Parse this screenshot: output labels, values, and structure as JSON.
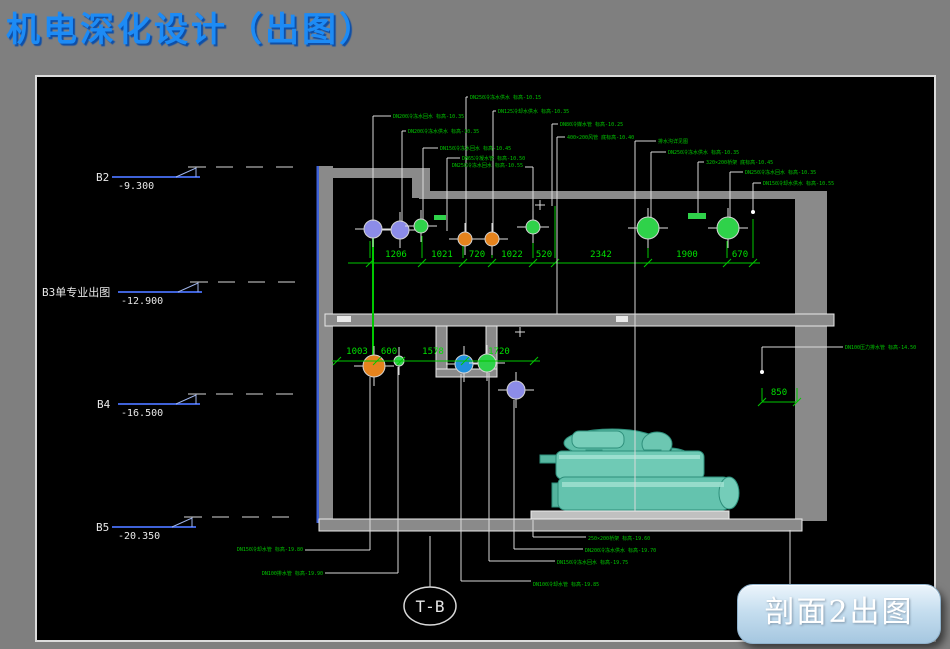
{
  "page": {
    "title": "机电深化设计（出图）",
    "title_color": "#1d8bf5",
    "background": "#7f7f7f"
  },
  "button": {
    "label": "剖面2出图"
  },
  "grid_bubble": {
    "label": "T-B",
    "cx": 430,
    "cy": 606
  },
  "levels": [
    {
      "name": "B2",
      "elev": "-9.300",
      "y": 177,
      "nx": 96,
      "ex": 118,
      "lx1": 112,
      "lx2": 200
    },
    {
      "name": "B3单专业出图",
      "elev": "-12.900",
      "y": 292,
      "nx": 42,
      "ex": 121,
      "lx1": 118,
      "lx2": 202
    },
    {
      "name": "B4",
      "elev": "-16.500",
      "y": 404,
      "nx": 97,
      "ex": 121,
      "lx1": 118,
      "lx2": 200
    },
    {
      "name": "B5",
      "elev": "-20.350",
      "y": 527,
      "nx": 96,
      "ex": 118,
      "lx1": 112,
      "lx2": 196
    }
  ],
  "dimensions": {
    "top": {
      "y": 263,
      "x1": 348,
      "x2": 760,
      "label_y": 257,
      "ticks": [
        370,
        422,
        463,
        492,
        533,
        555,
        648,
        727,
        753
      ],
      "labels": [
        [
          "1206",
          396
        ],
        [
          "1021",
          442
        ],
        [
          "720",
          477
        ],
        [
          "1022",
          512
        ],
        [
          "520",
          544
        ],
        [
          "2342",
          601
        ],
        [
          "1900",
          687
        ],
        [
          "670",
          740
        ]
      ]
    },
    "mid": {
      "y": 361,
      "x1": 332,
      "x2": 540,
      "label_y": 354,
      "ticks": [
        337,
        377,
        401,
        465,
        534
      ],
      "labels": [
        [
          "1003",
          357
        ],
        [
          "600",
          389
        ],
        [
          "1578",
          433
        ],
        [
          "1720",
          499
        ]
      ]
    },
    "side": {
      "y": 402,
      "x1": 762,
      "x2": 797,
      "label_y": 395,
      "ticks": [
        762,
        797
      ],
      "labels": [
        [
          "850",
          779
        ]
      ]
    }
  },
  "pipe_colors": {
    "purple": "#8c8ce8",
    "green": "#2fd24a",
    "orange": "#e5831d",
    "blue": "#2090dd"
  },
  "pipes": [
    [
      373,
      229,
      9,
      "purple"
    ],
    [
      400,
      230,
      9,
      "purple"
    ],
    [
      421,
      226,
      7,
      "green"
    ],
    [
      465,
      239,
      7,
      "orange"
    ],
    [
      492,
      239,
      7,
      "orange"
    ],
    [
      533,
      227,
      7,
      "green"
    ],
    [
      648,
      228,
      11,
      "green"
    ],
    [
      728,
      228,
      11,
      "green"
    ],
    [
      374,
      366,
      11,
      "orange"
    ],
    [
      399,
      361,
      5,
      "green"
    ],
    [
      464,
      364,
      9,
      "blue"
    ],
    [
      487,
      363,
      9,
      "green"
    ],
    [
      516,
      390,
      9,
      "purple"
    ]
  ],
  "annotations": [
    {
      "t": "DN250冷冻水供水 标高-10.15",
      "x": 470,
      "y": 99,
      "l": [
        466,
        232
      ]
    },
    {
      "t": "DN125冷却水供水 标高-10.35",
      "x": 498,
      "y": 113,
      "l": [
        493,
        232
      ]
    },
    {
      "t": "DN200冷冻水回水 标高-10.35",
      "x": 393,
      "y": 118,
      "l": [
        373,
        221
      ]
    },
    {
      "t": "DN80冷媒水管 标高-10.25",
      "x": 560,
      "y": 126,
      "l": [
        552,
        206
      ]
    },
    {
      "t": "DN200冷冻水供水 标高-10.35",
      "x": 408,
      "y": 133,
      "l": [
        402,
        222
      ]
    },
    {
      "t": "400×200风管 底标高-10.40",
      "x": 567,
      "y": 139,
      "l": [
        557,
        314
      ]
    },
    {
      "t": "排水沟详见图",
      "x": 658,
      "y": 143,
      "l": [
        635,
        511
      ]
    },
    {
      "t": "DN150冷冻水回水 标高-10.45",
      "x": 440,
      "y": 150,
      "l": [
        423,
        219
      ]
    },
    {
      "t": "DN250冷冻水供水 标高-10.35",
      "x": 668,
      "y": 154,
      "l": [
        651,
        218
      ]
    },
    {
      "t": "DN65冷凝水管 标高-10.50",
      "x": 462,
      "y": 160,
      "l": [
        447,
        231
      ]
    },
    {
      "t": "320×200桥架 底标高-10.45",
      "x": 706,
      "y": 164,
      "l": [
        698,
        213
      ]
    },
    {
      "t": "DN250冷冻水回水 标高-10.55",
      "x": 523,
      "y": 167,
      "a": "e"
    },
    {
      "t": "DN250冷冻水回水 标高-10.35",
      "x": 745,
      "y": 174,
      "l": [
        730,
        218
      ]
    },
    {
      "t": "DN150冷却水供水 标高-10.55",
      "x": 763,
      "y": 185,
      "l": [
        753,
        211
      ]
    },
    {
      "t": "DN100压力排水管 标高-14.50",
      "x": 845,
      "y": 349
    },
    {
      "t": "DN150冷却水管 标高-19.80",
      "x": 303,
      "y": 551,
      "a": "e"
    },
    {
      "t": "DN100排水管 标高-19.90",
      "x": 323,
      "y": 575,
      "a": "e"
    },
    {
      "t": "250×200桥架 标高-19.60",
      "x": 588,
      "y": 540
    },
    {
      "t": "DN200冷冻水供水 标高-19.70",
      "x": 585,
      "y": 552
    },
    {
      "t": "DN150冷冻水回水 标高-19.75",
      "x": 557,
      "y": 564
    },
    {
      "t": "DN100冷却水管 标高-19.85",
      "x": 533,
      "y": 586
    }
  ],
  "drawing": {
    "rects": [
      [
        316.5,
        166,
        3,
        357,
        "#3f62d8",
        "",
        "left-wall-highlight"
      ],
      [
        319,
        166,
        14,
        357,
        "",
        "",
        "left-wall"
      ],
      [
        319,
        168,
        111,
        10,
        "",
        "",
        "upper-ceiling-slab"
      ],
      [
        412,
        168,
        18,
        30,
        "",
        "",
        "ceiling-step"
      ],
      [
        419,
        191,
        408,
        8,
        "",
        "",
        "ceiling-slab"
      ],
      [
        795,
        191,
        32,
        330,
        "",
        "",
        "right-wall"
      ],
      [
        325,
        314,
        509,
        12,
        "",
        "#e8e8e8",
        "middle-floor-slab"
      ],
      [
        337,
        316,
        14,
        6,
        "#e8e8e8",
        "",
        "slab-opening"
      ],
      [
        616,
        316,
        12,
        6,
        "#e8e8e8",
        "",
        "slab-opening"
      ],
      [
        436,
        326,
        11,
        51,
        "",
        "#e8e8e8",
        "pit-wall-left"
      ],
      [
        486,
        326,
        11,
        51,
        "",
        "#e8e8e8",
        "pit-wall-right"
      ],
      [
        436,
        369,
        61,
        8,
        "",
        "#e8e8e8",
        "pit-floor"
      ],
      [
        319,
        519,
        483,
        12,
        "",
        "#e8e8e8",
        "bottom-floor-slab"
      ],
      [
        531,
        511,
        198,
        8,
        "#c0c0c0",
        "#eeeeee",
        "equipment-base"
      ],
      [
        434,
        215,
        12,
        5,
        "#2fd24a",
        "",
        "duct-symbol"
      ],
      [
        688,
        213,
        18,
        6,
        "#2fd24a",
        "",
        "duct-symbol"
      ]
    ],
    "wlines": [
      [
        525,
        167,
        533,
        167
      ],
      [
        533,
        167,
        533,
        220
      ],
      [
        843,
        347,
        762,
        347
      ],
      [
        762,
        347,
        762,
        371
      ],
      [
        790,
        530,
        790,
        585
      ],
      [
        370,
        377,
        370,
        550
      ],
      [
        370,
        550,
        305,
        550
      ],
      [
        398,
        367,
        398,
        573
      ],
      [
        398,
        573,
        325,
        573
      ],
      [
        430,
        536,
        430,
        587
      ],
      [
        461,
        374,
        461,
        581
      ],
      [
        461,
        581,
        531,
        581
      ],
      [
        489,
        373,
        489,
        561
      ],
      [
        489,
        561,
        555,
        561
      ],
      [
        514,
        400,
        514,
        549
      ],
      [
        514,
        549,
        583,
        549
      ],
      [
        533,
        520,
        533,
        537
      ],
      [
        533,
        537,
        586,
        537
      ],
      [
        535,
        205,
        545,
        205
      ],
      [
        540,
        200,
        540,
        210
      ],
      [
        515,
        332,
        525,
        332
      ],
      [
        520,
        327,
        520,
        337
      ]
    ],
    "glines": [
      [
        373,
        238,
        373,
        356,
        2
      ],
      [
        348,
        263,
        760,
        263
      ],
      [
        422,
        258,
        422,
        236
      ],
      [
        463,
        258,
        463,
        246
      ],
      [
        492,
        258,
        492,
        246
      ],
      [
        533,
        258,
        533,
        238
      ],
      [
        555,
        258,
        555,
        206
      ],
      [
        648,
        258,
        648,
        241
      ],
      [
        727,
        258,
        727,
        241
      ],
      [
        753,
        258,
        753,
        219
      ],
      [
        370,
        258,
        370,
        241
      ],
      [
        332,
        361,
        540,
        361
      ],
      [
        762,
        402,
        797,
        402
      ],
      [
        762,
        388,
        762,
        401
      ],
      [
        797,
        388,
        797,
        401
      ]
    ],
    "dots": [
      [
        753,
        212
      ],
      [
        762,
        372
      ]
    ]
  }
}
